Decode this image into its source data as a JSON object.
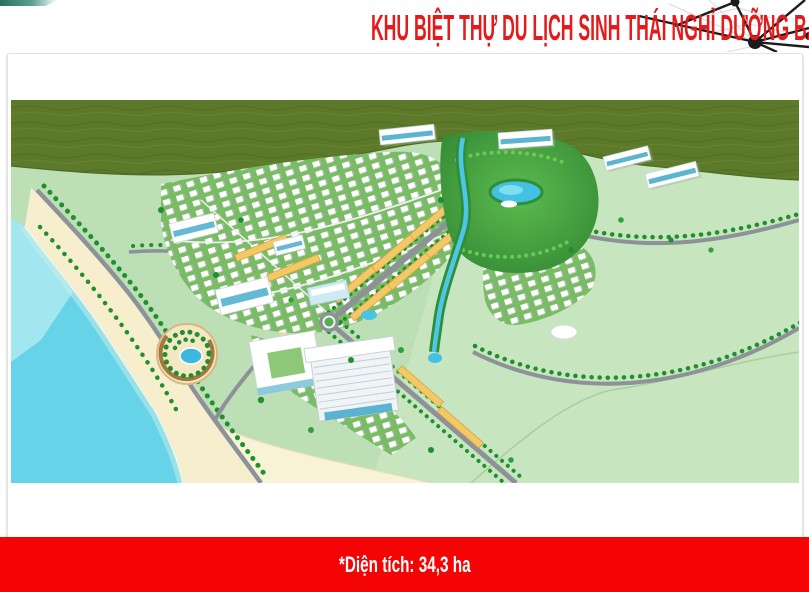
{
  "header": {
    "title": "KHU BIỆT THỰ DU LỊCH SINH THÁI NGHỈ DƯỠNG BÃI VÒNG – TP.PHÚ QUỐC"
  },
  "footer": {
    "area_label": "*Diện tích: 34,3 ha"
  },
  "graphics": {
    "top_right_motif": "network-nodes-icon",
    "main_image": "aerial-master-plan-render"
  },
  "colors": {
    "title_red": "#e31b1b",
    "footer_red": "#f40404",
    "teal_accent": "#2a6e62",
    "sea": "#66d3e9",
    "sea_light": "#a8e8f1",
    "sand": "#f6eecd",
    "forest": "#5d7a2b",
    "ground": "#bcdfb6",
    "field": "#c7e5bf",
    "road": "#8d9298",
    "tree": "#1f8f2f",
    "shophouse_yellow": "#f3c967",
    "glass_blue": "#3fa8c8",
    "lake_blue": "#44c0e2"
  }
}
